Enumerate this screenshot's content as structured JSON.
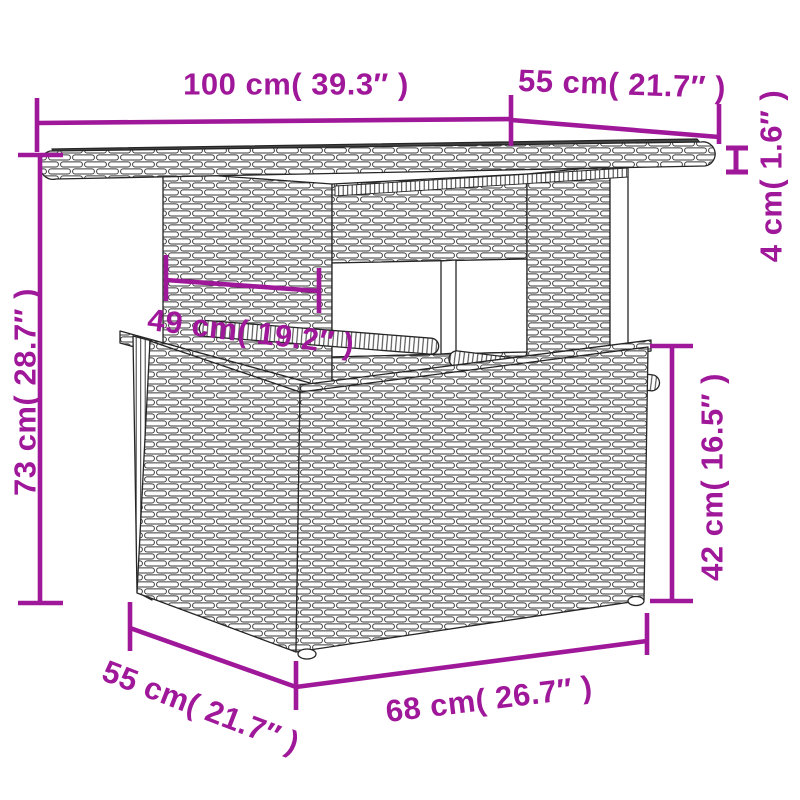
{
  "figure": {
    "type": "product-dimension-diagram",
    "subject": "poly-rattan garden table line drawing",
    "accent_color": "#A0189A",
    "background_color": "#ffffff"
  },
  "labels": {
    "top_width": "100 cm( 39.3″ )",
    "top_depth": "55 cm( 21.7″ )",
    "top_thickness": "4 cm( 1.6″ )",
    "overall_height": "73 cm( 28.7″ )",
    "pedestal_width": "49 cm( 19.2″ )",
    "base_height": "42 cm( 16.5″ )",
    "base_depth": "55 cm( 21.7″ )",
    "base_width": "68 cm( 26.7″ )"
  }
}
